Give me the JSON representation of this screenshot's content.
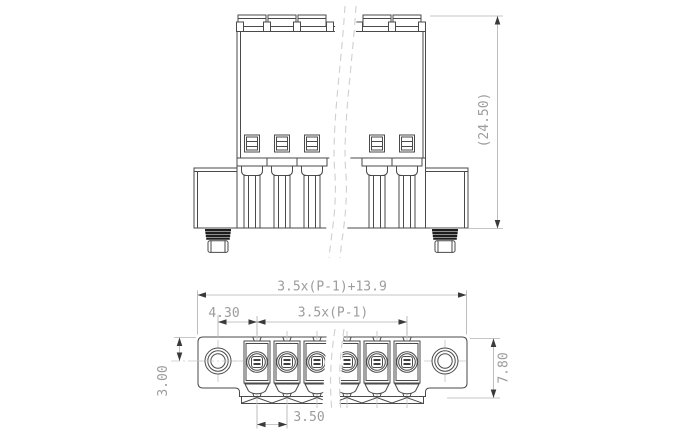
{
  "colors": {
    "edge": "#4a4a4a",
    "dark": "#1d1d1d",
    "dim": "#b3b3b3",
    "centerline": "#c6c6c6",
    "break": "#cfcfcf",
    "text": "#9c9c9c",
    "arrow": "#3a3a3a",
    "background": "#ffffff"
  },
  "front_view": {
    "height_dim": "(24.50)"
  },
  "bottom_view": {
    "overall_width_dim": "3.5x(P-1)+13.9",
    "hole_to_pole_dim": "4.30",
    "pole_span_dim": "3.5x(P-1)",
    "edge_to_hole_dim": "3.00",
    "depth_dim": "7.80",
    "pitch_dim": "3.50"
  }
}
